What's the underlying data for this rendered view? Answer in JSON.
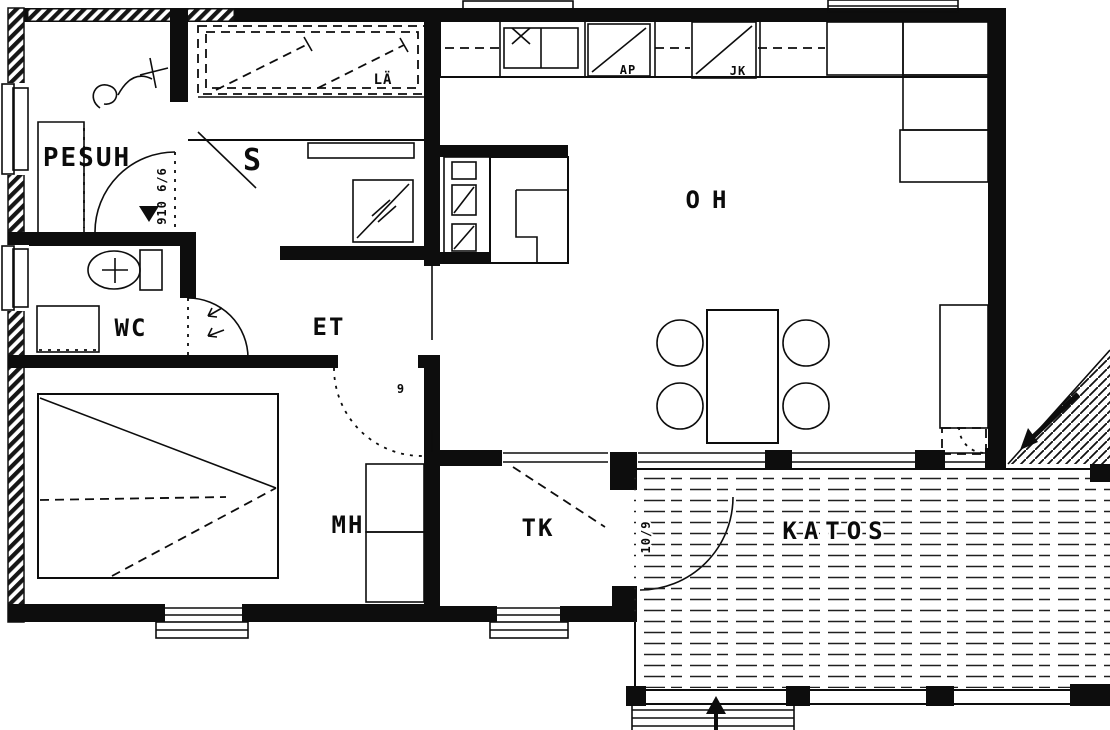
{
  "drawing": {
    "kind": "architectural floor plan, black ink on white (scanned)",
    "colors": {
      "ink": "#0b0b0b",
      "paper": "#ffffff"
    }
  },
  "labels": {
    "pesuh": "PESUH",
    "sauna": "S",
    "la": "LÄ",
    "wc": "WC",
    "et": "ET",
    "oh": "OH",
    "mh": "MH",
    "tk": "TK",
    "katos": "KATOS",
    "ap": "AP",
    "jk": "JK"
  },
  "door_marks": {
    "sauna_door": "910 6/6",
    "deck_door": "10/9",
    "bedroom_door": "9"
  }
}
